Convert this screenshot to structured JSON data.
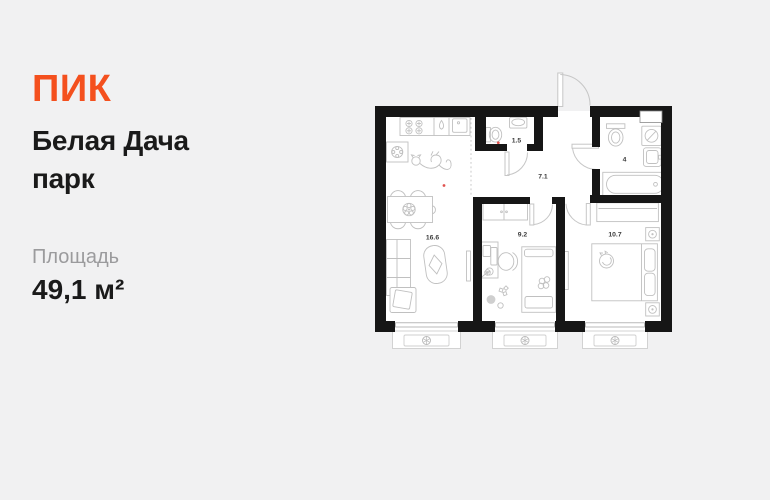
{
  "brand": {
    "logo_text": "ПИК",
    "brand_color": "#F4501E"
  },
  "listing": {
    "title": "Белая Дача парк",
    "title_lines": [
      "Белая Дача",
      "парк"
    ],
    "area_label": "Площадь",
    "area_value": "49,1 м²"
  },
  "floorplan": {
    "total_area_m2": "49,1",
    "rooms": [
      {
        "key": "kitchen-living-room",
        "area_m2": "16.6"
      },
      {
        "key": "bathroom-small",
        "area_m2": "1.5"
      },
      {
        "key": "hallway",
        "area_m2": "7.1"
      },
      {
        "key": "bathroom",
        "area_m2": "4"
      },
      {
        "key": "bedroom-children",
        "area_m2": "9.2"
      },
      {
        "key": "bedroom-master",
        "area_m2": "10.7"
      }
    ]
  },
  "colors": {
    "background": "#F1F1F2",
    "walls": "#161616",
    "furniture_stroke": "#C0C0C0",
    "text_primary": "#1A1A1A",
    "text_secondary": "#9B9B9D",
    "accent_dot": "#E0524E"
  }
}
